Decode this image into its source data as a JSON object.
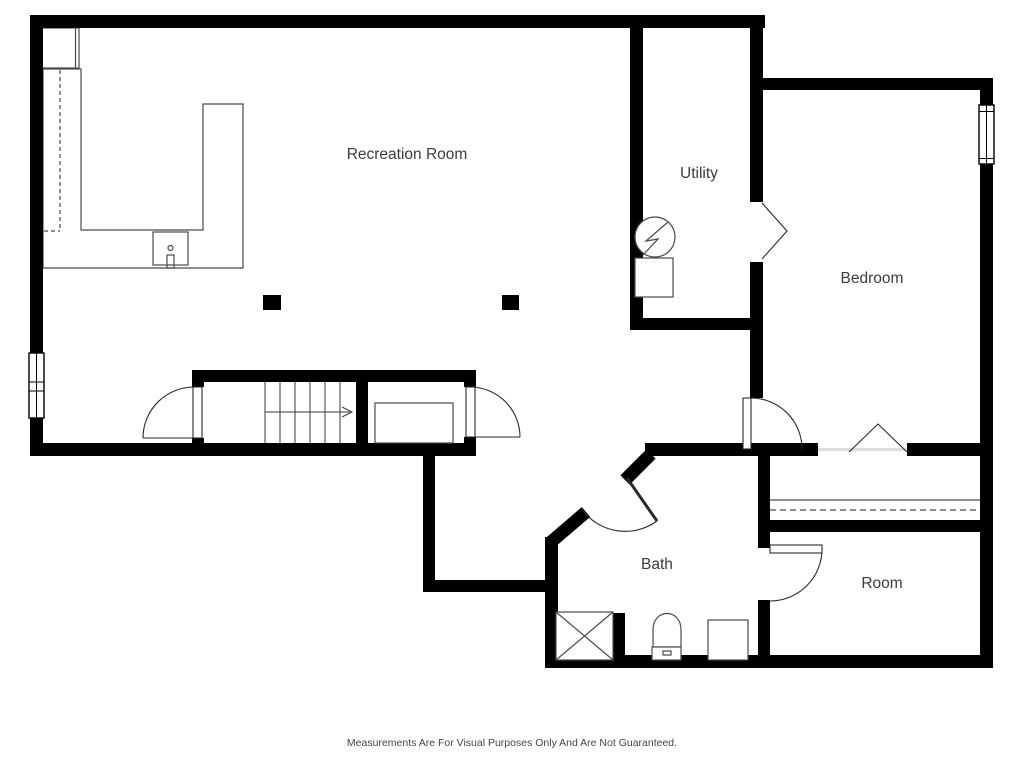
{
  "plan_labels": {
    "recreation_room": "Recreation Room",
    "utility": "Utility",
    "bedroom": "Bedroom",
    "bath": "Bath",
    "room": "Room"
  },
  "footer": {
    "disclaimer": "Measurements Are For Visual Purposes Only And Are Not Guaranteed."
  },
  "colors": {
    "wall": "#000000",
    "fixture_line": "#4a4a4a",
    "label_text": "#3b3b3b",
    "background": "#ffffff"
  }
}
